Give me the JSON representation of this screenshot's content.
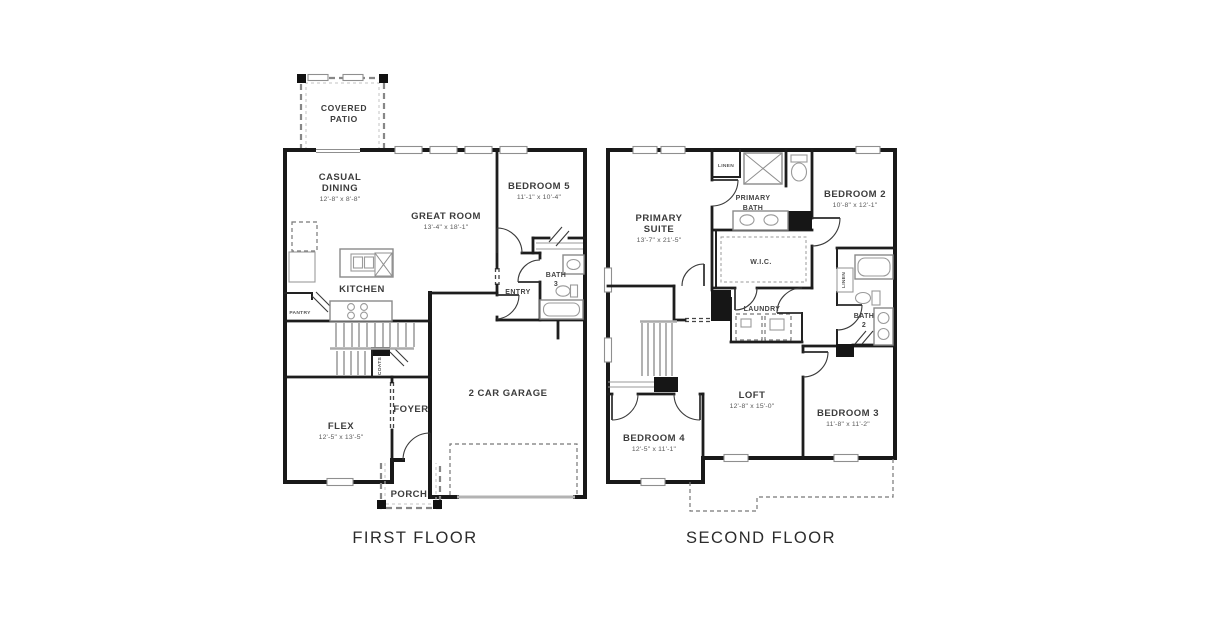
{
  "first_floor": {
    "title": "FIRST FLOOR",
    "rooms": {
      "covered_patio": {
        "line1": "COVERED",
        "line2": "PATIO"
      },
      "casual_dining": {
        "line1": "CASUAL",
        "line2": "DINING",
        "dims": "12'-8\" x 8'-8\""
      },
      "great_room": {
        "label": "GREAT ROOM",
        "dims": "13'-4\" x 18'-1\""
      },
      "bedroom5": {
        "label": "BEDROOM 5",
        "dims": "11'-1\" x 10'-4\""
      },
      "kitchen": {
        "label": "KITCHEN"
      },
      "pantry": {
        "label": "PANTRY"
      },
      "bath3": {
        "line1": "BATH",
        "line2": "3"
      },
      "entry": {
        "label": "ENTRY"
      },
      "coats": {
        "label": "COATS"
      },
      "foyer": {
        "label": "FOYER"
      },
      "flex": {
        "label": "FLEX",
        "dims": "12'-5\" x 13'-5\""
      },
      "garage": {
        "label": "2 CAR GARAGE"
      },
      "porch": {
        "label": "PORCH"
      }
    }
  },
  "second_floor": {
    "title": "SECOND FLOOR",
    "rooms": {
      "primary_suite": {
        "line1": "PRIMARY",
        "line2": "SUITE",
        "dims": "13'-7\" x 21'-5\""
      },
      "primary_bath": {
        "line1": "PRIMARY",
        "line2": "BATH"
      },
      "linen_bath": {
        "label": "LINEN"
      },
      "bedroom2": {
        "label": "BEDROOM 2",
        "dims": "10'-8\" x 12'-1\""
      },
      "wic": {
        "label": "W.I.C."
      },
      "laundry": {
        "label": "LAUNDRY"
      },
      "bath2": {
        "line1": "BATH",
        "line2": "2"
      },
      "linen_hall": {
        "label": "LINEN"
      },
      "loft": {
        "label": "LOFT",
        "dims": "12'-8\" x 15'-0\""
      },
      "bedroom3": {
        "label": "BEDROOM 3",
        "dims": "11'-8\" x 11'-2\""
      },
      "bedroom4": {
        "label": "BEDROOM 4",
        "dims": "12'-5\" x 11'-1\""
      }
    }
  }
}
